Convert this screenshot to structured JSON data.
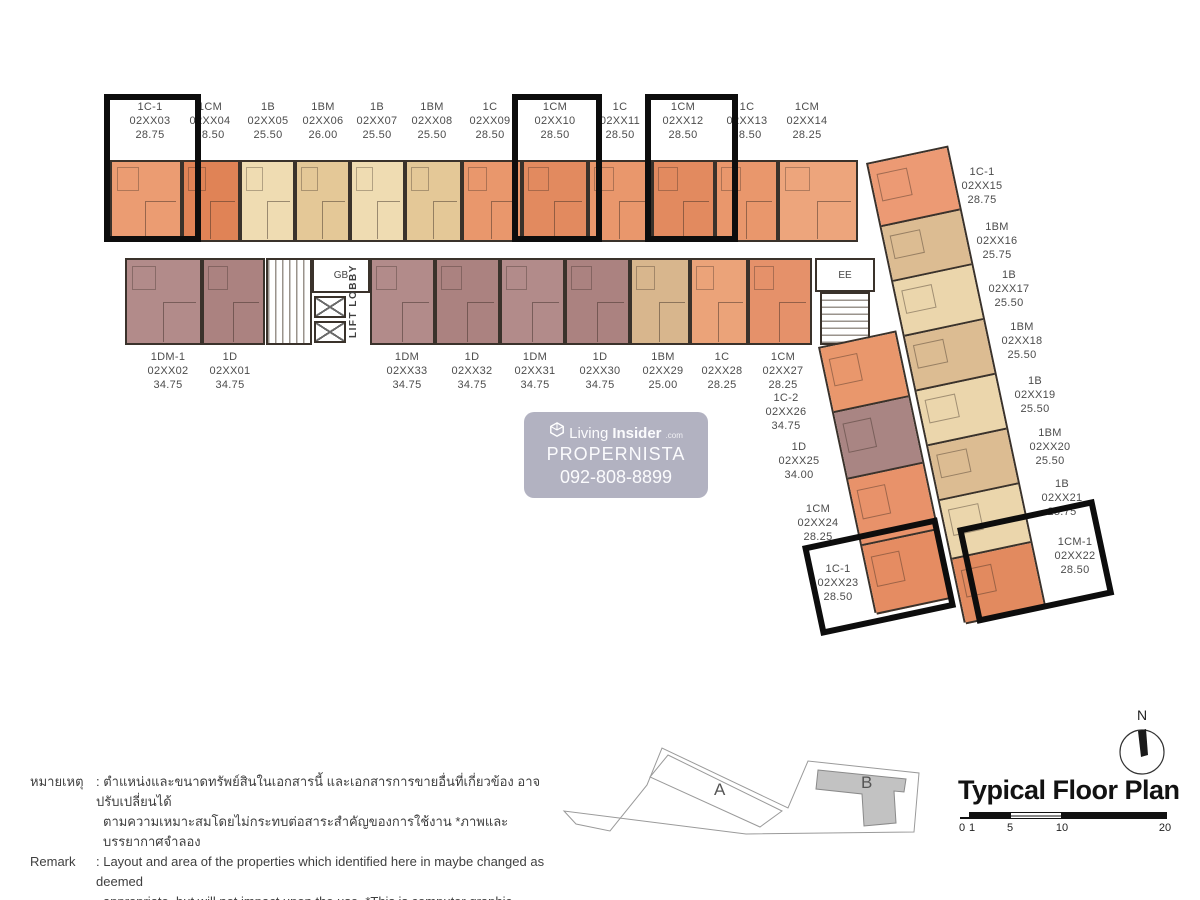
{
  "watermark": {
    "brand_light": "Living",
    "brand_bold": "Insider",
    "brand_tld": ".com",
    "line2": "PROPERNISTA",
    "line3": "092-808-8899"
  },
  "plan": {
    "core": {
      "gb": "GB",
      "lift_lobby": "LIFT LOBBY",
      "ee": "EE"
    },
    "top_units": [
      {
        "type": "1C-1",
        "code": "02XX03",
        "area": "28.75",
        "color": "#EB9C72",
        "x": 110,
        "w": 72,
        "cx": 150,
        "boxed": true
      },
      {
        "type": "1CM",
        "code": "02XX04",
        "area": "28.50",
        "color": "#E08356",
        "x": 182,
        "w": 58,
        "cx": 210,
        "boxed": false
      },
      {
        "type": "1B",
        "code": "02XX05",
        "area": "25.50",
        "color": "#EFDCB2",
        "x": 240,
        "w": 55,
        "cx": 268,
        "boxed": false
      },
      {
        "type": "1BM",
        "code": "02XX06",
        "area": "26.00",
        "color": "#E4C897",
        "x": 295,
        "w": 55,
        "cx": 323,
        "boxed": false
      },
      {
        "type": "1B",
        "code": "02XX07",
        "area": "25.50",
        "color": "#EFDCB2",
        "x": 350,
        "w": 55,
        "cx": 377,
        "boxed": false
      },
      {
        "type": "1BM",
        "code": "02XX08",
        "area": "25.50",
        "color": "#E4C897",
        "x": 405,
        "w": 57,
        "cx": 432,
        "boxed": false
      },
      {
        "type": "1C",
        "code": "02XX09",
        "area": "28.50",
        "color": "#E9976C",
        "x": 462,
        "w": 60,
        "cx": 490,
        "boxed": false
      },
      {
        "type": "1CM",
        "code": "02XX10",
        "area": "28.50",
        "color": "#E28A5F",
        "x": 522,
        "w": 66,
        "cx": 555,
        "boxed": true
      },
      {
        "type": "1C",
        "code": "02XX11",
        "area": "28.50",
        "color": "#E9976C",
        "x": 588,
        "w": 64,
        "cx": 620,
        "boxed": false
      },
      {
        "type": "1CM",
        "code": "02XX12",
        "area": "28.50",
        "color": "#E28A5F",
        "x": 652,
        "w": 63,
        "cx": 683,
        "boxed": true
      },
      {
        "type": "1C",
        "code": "02XX13",
        "area": "28.50",
        "color": "#E9976C",
        "x": 715,
        "w": 63,
        "cx": 747,
        "boxed": false
      },
      {
        "type": "1CM",
        "code": "02XX14",
        "area": "28.25",
        "color": "#EDA57C",
        "x": 778,
        "w": 80,
        "cx": 807,
        "boxed": false
      }
    ],
    "middle_units": [
      {
        "type": "1DM-1",
        "code": "02XX02",
        "area": "34.75",
        "color": "#B28B8A",
        "x": 125,
        "w": 77,
        "cx": 168
      },
      {
        "type": "1D",
        "code": "02XX01",
        "area": "34.75",
        "color": "#AB8280",
        "x": 202,
        "w": 63,
        "cx": 230
      },
      {
        "type": "1DM",
        "code": "02XX33",
        "area": "34.75",
        "color": "#B28B8A",
        "x": 370,
        "w": 65,
        "cx": 407
      },
      {
        "type": "1D",
        "code": "02XX32",
        "area": "34.75",
        "color": "#AB8280",
        "x": 435,
        "w": 65,
        "cx": 472
      },
      {
        "type": "1DM",
        "code": "02XX31",
        "area": "34.75",
        "color": "#B28B8A",
        "x": 500,
        "w": 65,
        "cx": 535
      },
      {
        "type": "1D",
        "code": "02XX30",
        "area": "34.75",
        "color": "#AB8280",
        "x": 565,
        "w": 65,
        "cx": 600
      },
      {
        "type": "1BM",
        "code": "02XX29",
        "area": "25.00",
        "color": "#D8B68D",
        "x": 630,
        "w": 60,
        "cx": 663
      },
      {
        "type": "1C",
        "code": "02XX28",
        "area": "28.25",
        "color": "#EBA379",
        "x": 690,
        "w": 58,
        "cx": 722
      },
      {
        "type": "1CM",
        "code": "02XX27",
        "area": "28.25",
        "color": "#E5916A",
        "x": 748,
        "w": 64,
        "cx": 783
      }
    ],
    "right_wing_units": [
      {
        "type": "1C-1",
        "code": "02XX15",
        "area": "28.75",
        "color": "#EC9A74",
        "h": 64,
        "lx": 982,
        "ly": 165
      },
      {
        "type": "1BM",
        "code": "02XX16",
        "area": "25.75",
        "color": "#DCBC92",
        "h": 56,
        "lx": 997,
        "ly": 220
      },
      {
        "type": "1B",
        "code": "02XX17",
        "area": "25.50",
        "color": "#EBD6AC",
        "h": 56,
        "lx": 1009,
        "ly": 268
      },
      {
        "type": "1BM",
        "code": "02XX18",
        "area": "25.50",
        "color": "#DCBC92",
        "h": 56,
        "lx": 1022,
        "ly": 320
      },
      {
        "type": "1B",
        "code": "02XX19",
        "area": "25.50",
        "color": "#EBD6AC",
        "h": 56,
        "lx": 1035,
        "ly": 374
      },
      {
        "type": "1BM",
        "code": "02XX20",
        "area": "25.50",
        "color": "#DCBC92",
        "h": 56,
        "lx": 1050,
        "ly": 426
      },
      {
        "type": "1B",
        "code": "02XX21",
        "area": "25.75",
        "color": "#EBD6AC",
        "h": 60,
        "lx": 1062,
        "ly": 477
      },
      {
        "type": "1CM-1",
        "code": "02XX22",
        "area": "28.50",
        "color": "#E28A5F",
        "h": 66,
        "lx": 1075,
        "ly": 535
      }
    ],
    "lower_wing_units": [
      {
        "type": "1C-2",
        "code": "02XX26",
        "area": "34.75",
        "color": "#E9976C",
        "h": 66,
        "lx": 786,
        "ly": 391
      },
      {
        "type": "1D",
        "code": "02XX25",
        "area": "34.00",
        "color": "#A98583",
        "h": 68,
        "lx": 799,
        "ly": 440
      },
      {
        "type": "1CM",
        "code": "02XX24",
        "area": "28.25",
        "color": "#E8926A",
        "h": 68,
        "lx": 818,
        "ly": 502
      },
      {
        "type": "1C-1",
        "code": "02XX23",
        "area": "28.50",
        "color": "#E58C62",
        "h": 70,
        "lx": 838,
        "ly": 562
      }
    ],
    "highlight_boxes": [
      {
        "x": 104,
        "y": 94,
        "w": 97,
        "h": 148,
        "rot": 0
      },
      {
        "x": 512,
        "y": 94,
        "w": 90,
        "h": 148,
        "rot": 0
      },
      {
        "x": 645,
        "y": 94,
        "w": 93,
        "h": 148,
        "rot": 0
      },
      {
        "x": 802,
        "y": 546,
        "w": 138,
        "h": 92,
        "rot": -12
      },
      {
        "x": 957,
        "y": 528,
        "w": 140,
        "h": 98,
        "rot": -12
      }
    ]
  },
  "notes": {
    "thai_label": "หมายเหตุ",
    "thai_line1": ": ตำแหน่งและขนาดทรัพย์สินในเอกสารนี้ และเอกสารการขายอื่นที่เกี่ยวข้อง อาจปรับเปลี่ยนได้",
    "thai_line2": "ตามความเหมาะสมโดยไม่กระทบต่อสาระสำคัญของการใช้งาน *ภาพและบรรยากาศจำลอง",
    "remark_label": "Remark",
    "remark_line1": ": Layout and area of the properties which identified here in maybe changed as deemed",
    "remark_line2": "appropriate, but will not impact upon the use. *This is computer graphic generated."
  },
  "footer": {
    "title": "Typical Floor Plan",
    "north_label": "N",
    "scale_ticks": [
      "0",
      "1",
      "5",
      "10",
      "20"
    ],
    "keyplan": {
      "a_label": "A",
      "b_label": "B"
    }
  }
}
